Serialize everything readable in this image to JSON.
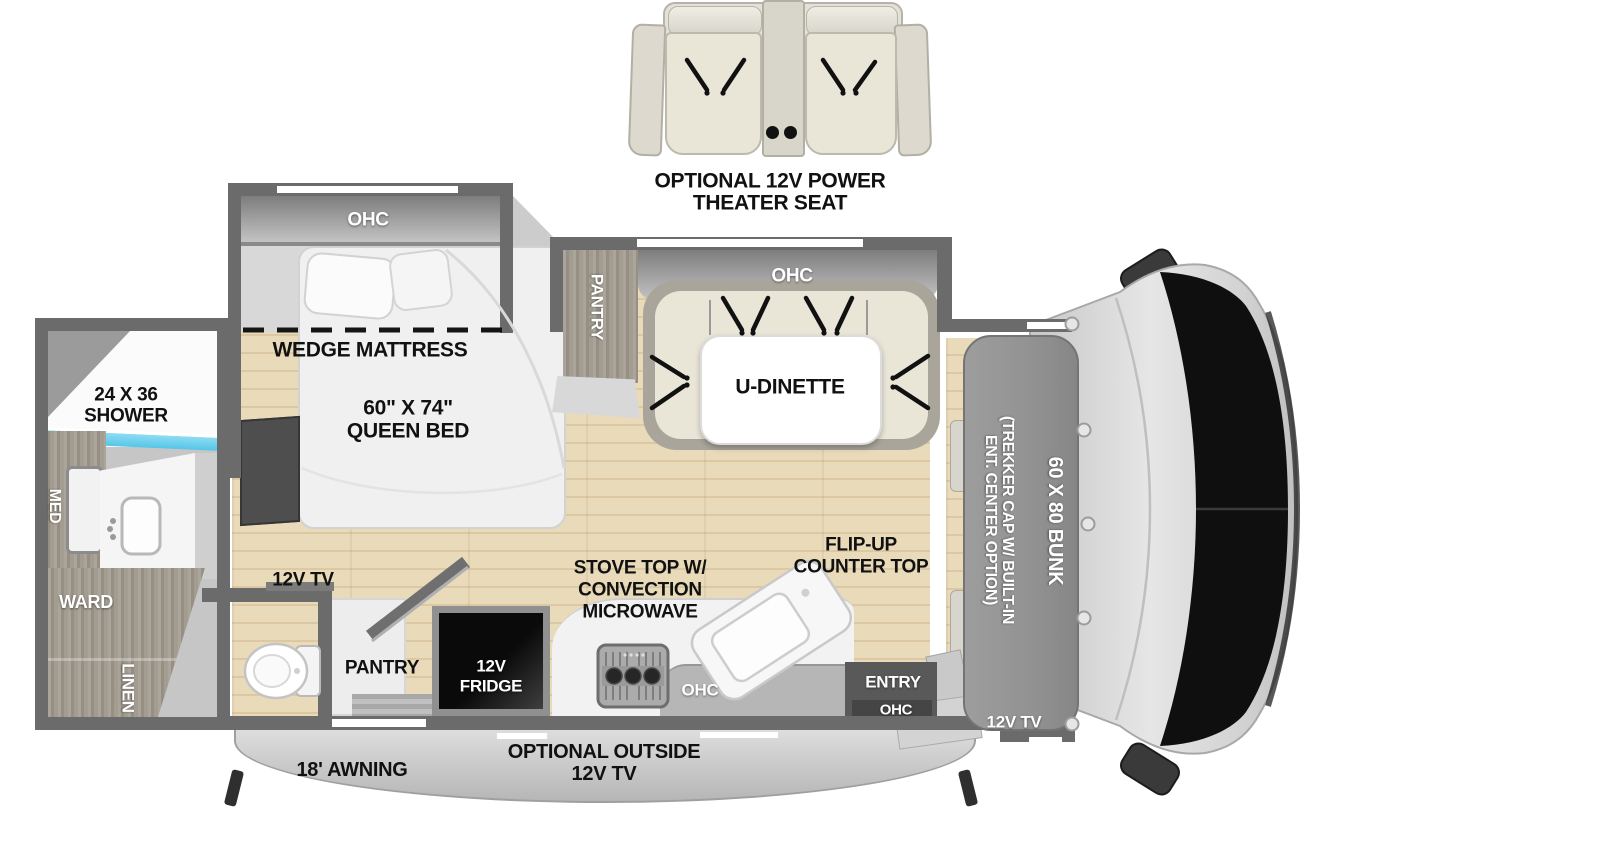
{
  "diagram_type": "rv-motorhome-floorplan-top-view",
  "labels": {
    "theater_line1": "OPTIONAL 12V POWER",
    "theater_line2": "THEATER SEAT",
    "bedroom_ohc": "OHC",
    "wedge_mattress": "WEDGE MATTRESS",
    "queen_bed_line1": "60\" X 74\"",
    "queen_bed_line2": "QUEEN BED",
    "shower_line1": "24 X 36",
    "shower_line2": "SHOWER",
    "med": "MED",
    "ward": "WARD",
    "linen": "LINEN",
    "bedroom_tv": "12V TV",
    "dinette_pantry": "PANTRY",
    "dinette_ohc": "OHC",
    "u_dinette": "U-DINETTE",
    "kitchen_pantry": "PANTRY",
    "fridge_line1": "12V",
    "fridge_line2": "FRIDGE",
    "stove_line1": "STOVE TOP W/",
    "stove_line2": "CONVECTION",
    "stove_line3": "MICROWAVE",
    "flip_line1": "FLIP-UP",
    "flip_line2": "COUNTER TOP",
    "kitchen_ohc": "OHC",
    "entry": "ENTRY",
    "entry_ohc": "OHC",
    "cab_tv": "12V TV",
    "bunk": "60 X 80 BUNK",
    "trekker_line1": "(TREKKER CAP W/ BUILT-IN",
    "trekker_line2": "ENT. CENTER OPTION)",
    "awning": "18' AWNING",
    "outside_tv_line1": "OPTIONAL OUTSIDE",
    "outside_tv_line2": "12V TV"
  },
  "colors": {
    "wall": "#6b6b6b",
    "floor_wood": "#e9dab9",
    "floor_line": "#dcc9a4",
    "cabinet_gray": "#b9b9b9",
    "woodgrain_gray": "#a29c90",
    "shower_accent": "#55c6e8",
    "upholstery": "#e9e5d7",
    "appliance_black": "#0a0a0a",
    "bunk_gray": "#929292",
    "awning_gray": "#cfcfcf",
    "label_black": "#111111",
    "label_white": "#ffffff"
  }
}
